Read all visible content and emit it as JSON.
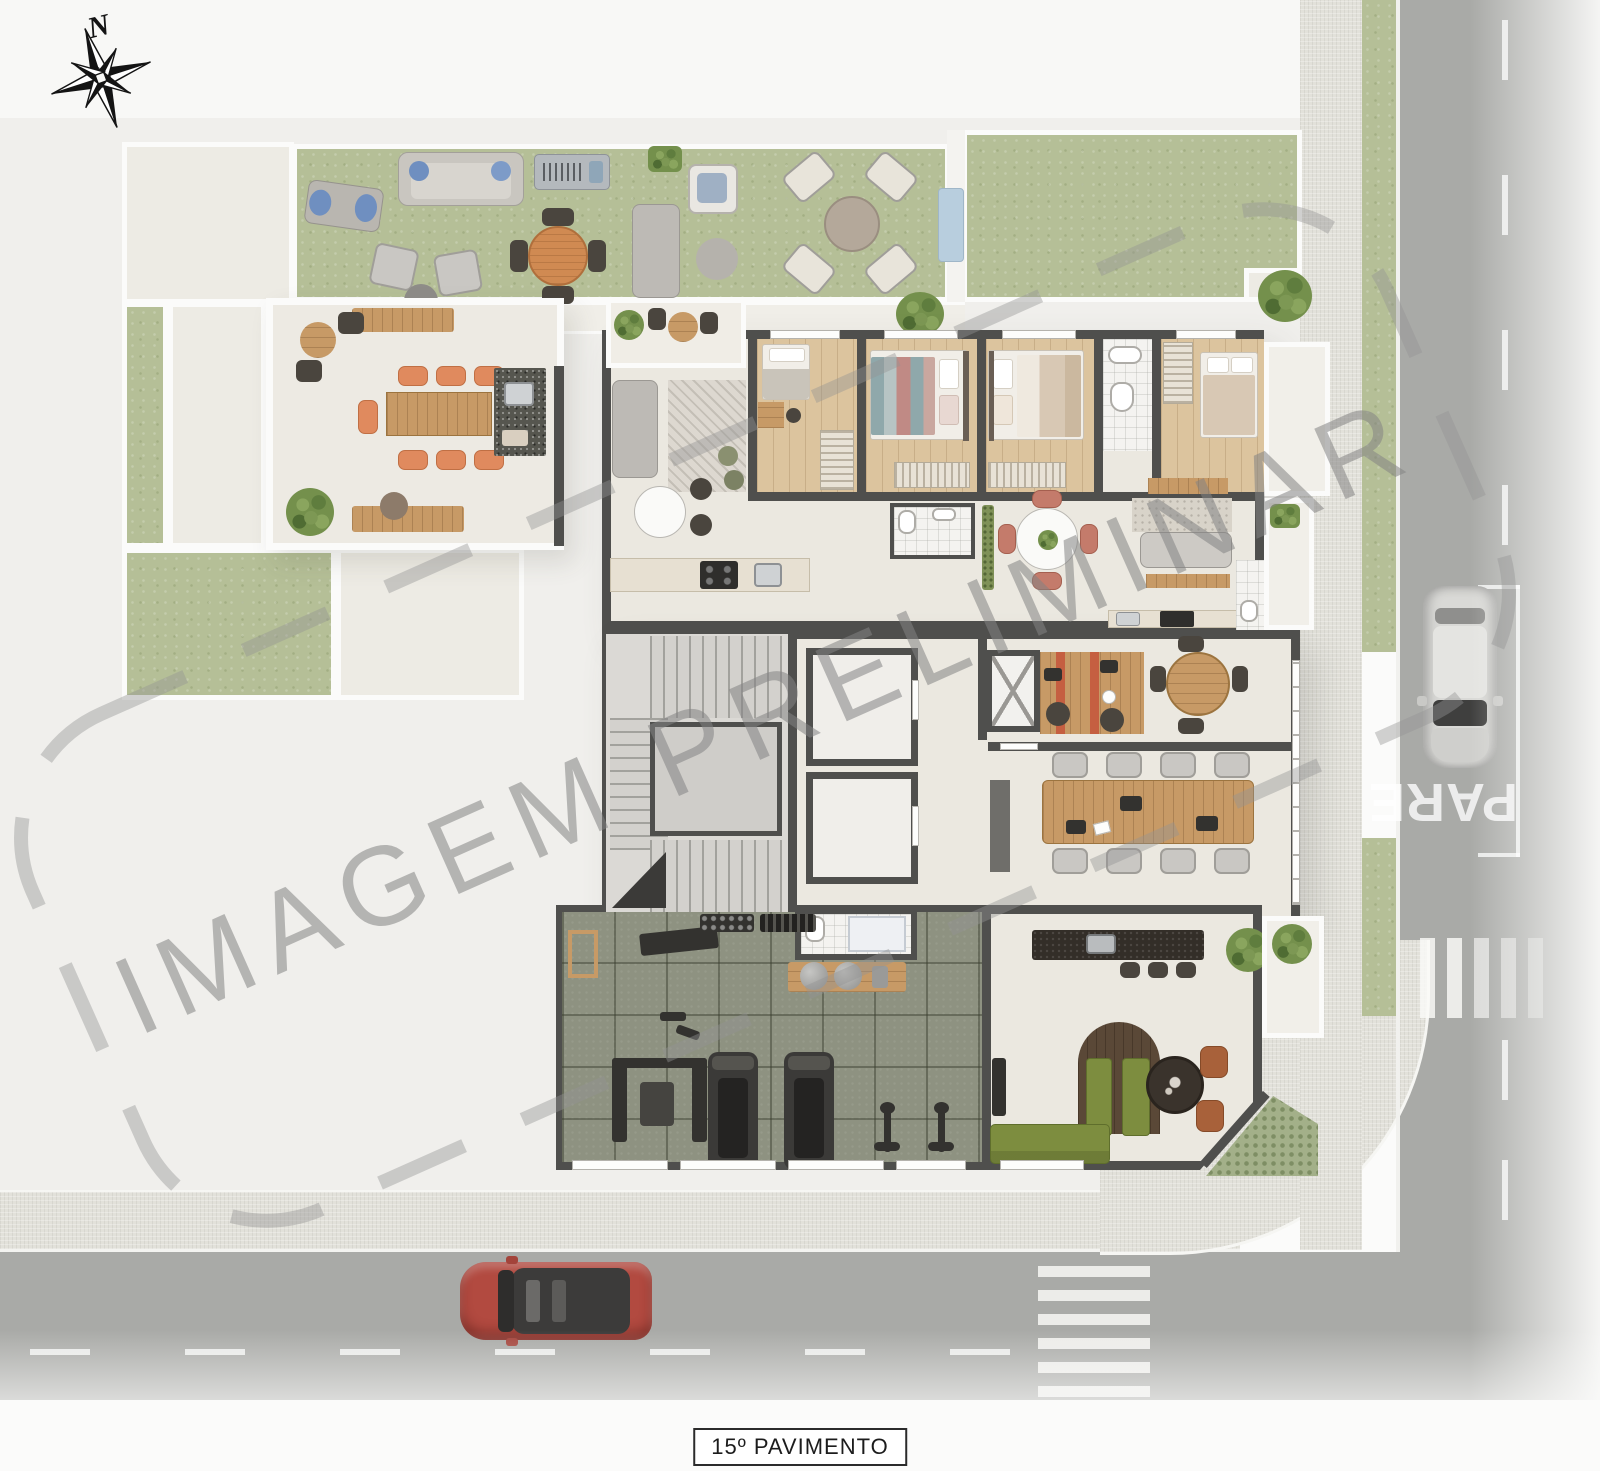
{
  "scene": {
    "type": "architectural floor plan rendering (top view)",
    "floor_label": "15º PAVIMENTO",
    "watermark": "IMAGEM PRELIMINAR",
    "compass_north": "N",
    "street_stop_marking": "PARE"
  },
  "palette": {
    "page_bg": "#fbfbfa",
    "plaza": "#f0efec",
    "sidewalk": "#e2e1da",
    "street": "#a9aaa7",
    "grass": "#b5bf97",
    "wall": "#4f4f4d",
    "cream_floor": "#ebe8e0",
    "wood_floor": "#dcc49e",
    "gym_floor": "#8e9281",
    "accent_orange": "#e08a5e",
    "sofa_green": "#7d8d3f",
    "bar_dark": "#332e28",
    "red_car": "#b24a40",
    "white_car": "#dcdcda"
  },
  "areas": [
    "rooftop garden lounge",
    "gourmet terrace with dining table",
    "open terrace",
    "apartment balcony",
    "apartment living room",
    "kitchen",
    "bedroom 1",
    "bedroom 2",
    "bedroom 3",
    "bedroom 4",
    "bathrooms",
    "living-dining with round table",
    "stair core",
    "elevators",
    "coworking desks",
    "round meeting nook",
    "meeting room with long table",
    "gym",
    "gym bathroom",
    "lounge bar with stools",
    "green booth sofa",
    "corner terrace",
    "street corner with crosswalks"
  ],
  "vehicles": [
    {
      "name": "red car",
      "street": "bottom street, facing left"
    },
    {
      "name": "white car",
      "street": "right street, facing down"
    }
  ]
}
